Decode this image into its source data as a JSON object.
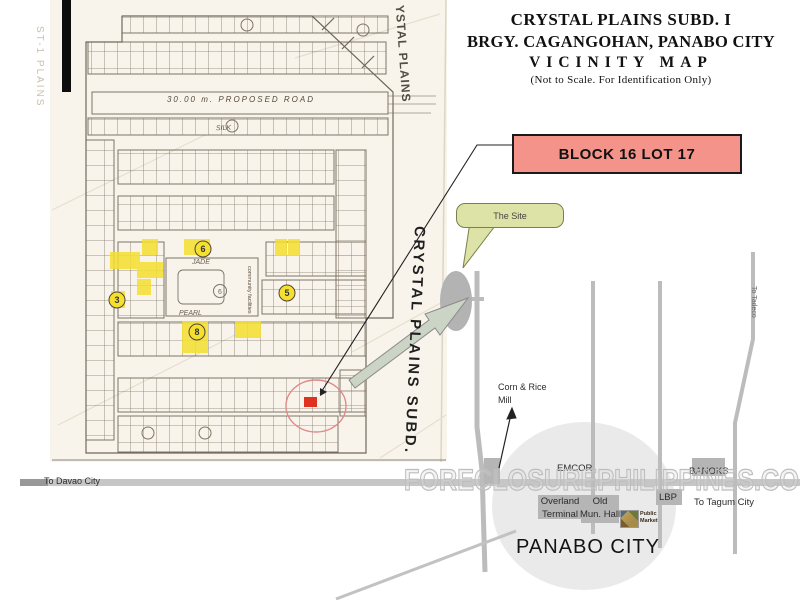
{
  "header": {
    "line1": "CRYSTAL PLAINS SUBD. I",
    "line2": "BRGY. CAGANGOHAN, PANABO CITY",
    "line3": "VICINITY MAP",
    "line4": "(Not  to Scale. For Identification Only)"
  },
  "callout": {
    "block_lot_label": "BLOCK 16 LOT 17",
    "site_label": "The Site"
  },
  "plat": {
    "proposed_road_label": "30.00 m.  PROPOSED  ROAD",
    "handwritten_top": "YSTAL PLAINS",
    "handwritten_left": "ST-1 PLAINS",
    "marker_label": "CRYSTAL PLAINS SUBD.",
    "center_label": "community facilities",
    "center_block_number": "6",
    "streets": [
      "SILK",
      "JADE",
      "PEARL"
    ],
    "block_numbers": [
      "3",
      "6",
      "5",
      "8"
    ]
  },
  "roadmap": {
    "to_davao_city": "To Davao City",
    "corn_rice_line1": "Corn & Rice",
    "corn_rice_line2": "Mill",
    "emcor": "EMCOR",
    "banoks": "BANOKS",
    "lbp": "LBP",
    "overland_line1": "Overland",
    "overland_line2": "Terminal",
    "old_hall_line1": "Old",
    "old_hall_line2": "Mun. Hall",
    "public_market_line1": "Public",
    "public_market_line2": "Market",
    "to_tagum_city": "To Tagum City",
    "to_tadeco": "To Tadeco",
    "city_name": "PANABO CITY"
  },
  "watermark": "FORECLOSUREPHILIPPINES.COM",
  "colors": {
    "highlight_box": "#f4938a",
    "site_bubble": "#dde3a6",
    "lot_highlight": "#f5e030",
    "target_lot": "#e03020",
    "road_gray": "#c4c4c4",
    "site_ellipse": "#b3b3b3",
    "arrow_fill": "#ccd5c5"
  }
}
